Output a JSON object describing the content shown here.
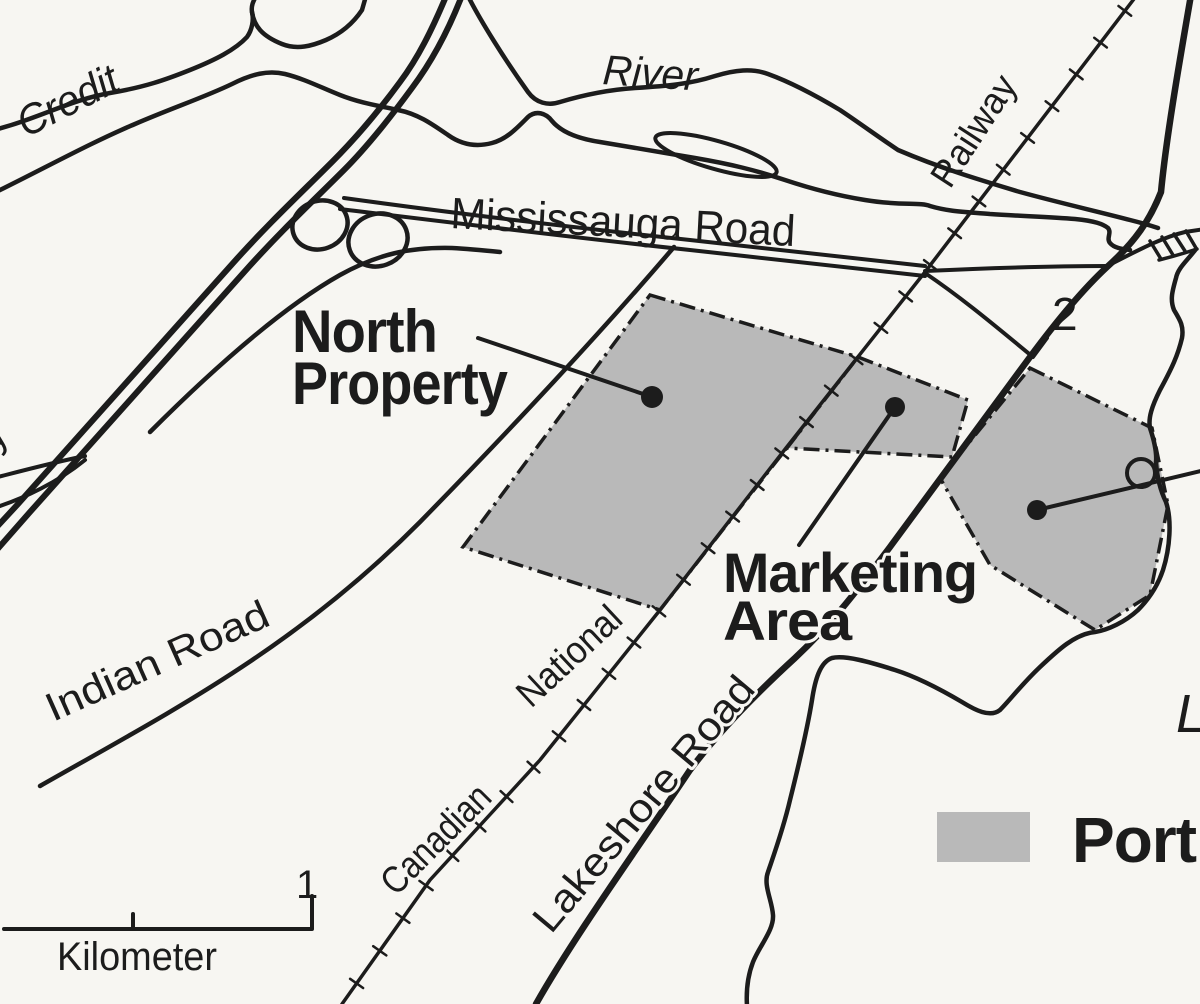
{
  "colors": {
    "paper": "#f7f6f2",
    "ink": "#1c1c1c",
    "shade": "#b9b9b9"
  },
  "labels": {
    "credit": "Credit",
    "river": "River",
    "mississauga_road": "Mississauga Road",
    "railway": "Railway",
    "highway_2": "2",
    "north_property_line1": "North",
    "north_property_line2": "Property",
    "marketing_area_line1": "Marketing",
    "marketing_area_line2": "Area",
    "canadian": "Canadian",
    "national": "National",
    "lakeshore_road": "Lakeshore Road",
    "indian_road": "Indian Road",
    "partial_highway_label": "y",
    "partial_lake_label": "L"
  },
  "legend": {
    "swatch_label": "Port"
  },
  "scale_bar": {
    "max_value": "1",
    "unit": "Kilometer"
  }
}
